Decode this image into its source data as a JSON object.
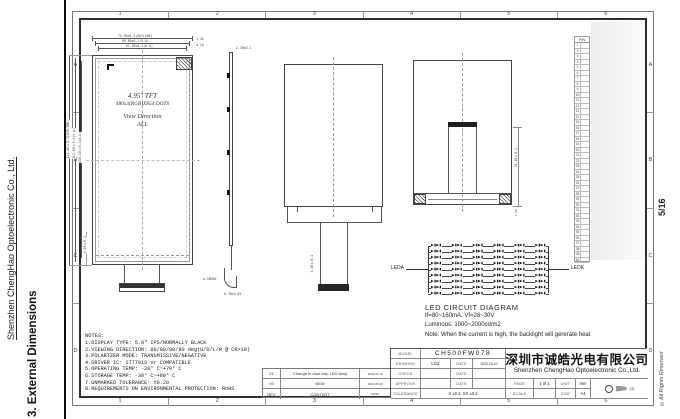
{
  "page": {
    "sidebar_company": "Shenzhen ChengHao Optoelectronic Co., Ltd.",
    "sidebar_section": "3. External Dimensions",
    "page_number": "5/16",
    "copyright": "©All Rights Reserved",
    "border_columns": [
      "1",
      "2",
      "3",
      "4",
      "5",
      "6"
    ],
    "border_rows": [
      "A",
      "B",
      "C",
      "D"
    ]
  },
  "front_view": {
    "title_line1": "4.95\" TFT",
    "title_line2": "480x3(RGB)X854 DOTS",
    "title_line3": "View Direction",
    "title_line4": "ALL",
    "dim_top_outline": "72.90±0.3(OUTLINE)",
    "dim_top_va": "68.80±0.2(V.A)",
    "dim_top_aa": "61.90±0.2(A.A)",
    "dim_right_small1": "1.45",
    "dim_right_small2": "4.16",
    "dim_left_outline": "121.40±0.3(OUTLINE)",
    "dim_left_va": "117.80±0.2(V.A)",
    "dim_left_aa": "110.10±0.2(A.A)",
    "dim_left_bottom": "9.50±0.5"
  },
  "side_view": {
    "dim_top": "2.30±0.1",
    "dim_hook": "0.50MAX",
    "dim_bottom": "0.30±0.05"
  },
  "back_view": {
    "dim_tail": "3.10±0.1"
  },
  "folded_view": {
    "dim_right": "78.10±0.2",
    "dim_bottom": "1.00"
  },
  "led_diagram": {
    "label_left": "LEDA",
    "label_right": "LEDK",
    "title": "LED CIRCUIT DIAGRAM",
    "spec_current": "If=80~160mA, Vf=28~30V",
    "spec_luminous": "Luminous: 1000~2000cd/m2",
    "note": "Note: When the current is high, the backlight will gererate heat",
    "rows": 9,
    "cols": 6,
    "diode_pair_glyph": "▶▮▶▮"
  },
  "pin_table": {
    "header": "P/N",
    "pin_count": 40
  },
  "notes": {
    "title": "NOTES:",
    "items": [
      "1.DISPLAY TYPE: 5.0\" IPS/NORMALLY BLACK",
      "2.VIEWING DIRECTION: 80/80/80/80 deg(U/D/L/R @ CR>10)",
      "3.POLARIZER MODE: TRANSMISSIVE/NEGATIVE",
      "4.DRIVER IC: ST7701S or COMPATIBLE",
      "5.OPERATING TEMP: -20° C~+70° C",
      "6.STORAGE TEMP: -30° C~+80° C",
      "7.UNMARKED TOLERANCE: ±0.20",
      "8.REQUIREMENTS ON ENVIRONMENTAL PROTECTION: RoHS"
    ]
  },
  "revision_table": {
    "rows": [
      {
        "rev": "V1",
        "content": "Change to dual chip LED lamp",
        "date": "2022.10.10"
      },
      {
        "rev": "V0",
        "content": "NEW",
        "date": "2022.08.20"
      },
      {
        "rev": "REV",
        "content": "CONTENT",
        "date": "DATA"
      }
    ]
  },
  "title_block": {
    "model_label": "MODEL",
    "model_value": "CH500FW078",
    "drawing_label": "DRAWING",
    "drawing_value": "LGZ",
    "date_label": "DATE",
    "drawing_date": "2022.10.10",
    "check_label": "CHECK",
    "approve_label": "APPROVE",
    "tolerance_label": "TOLERANCE",
    "tolerance_value": "X ±0.3, XX ±0.2",
    "page_label": "PAGE",
    "page_value": "1 of 1",
    "unit_label": "UNIT",
    "unit_value": "mm",
    "scale_label": "SCALE",
    "scale_value": "",
    "size_label": "SIZE",
    "size_value": "A4",
    "projection_note": "(3)",
    "company_cn": "深圳市诚皓光电有限公司",
    "company_en": "Shenzhen ChengHao Optoelectronic Co.,Ltd."
  },
  "colors": {
    "line": "#444444",
    "frame": "#2e2e2e",
    "connector": "#222222",
    "paper": "#ffffff"
  }
}
